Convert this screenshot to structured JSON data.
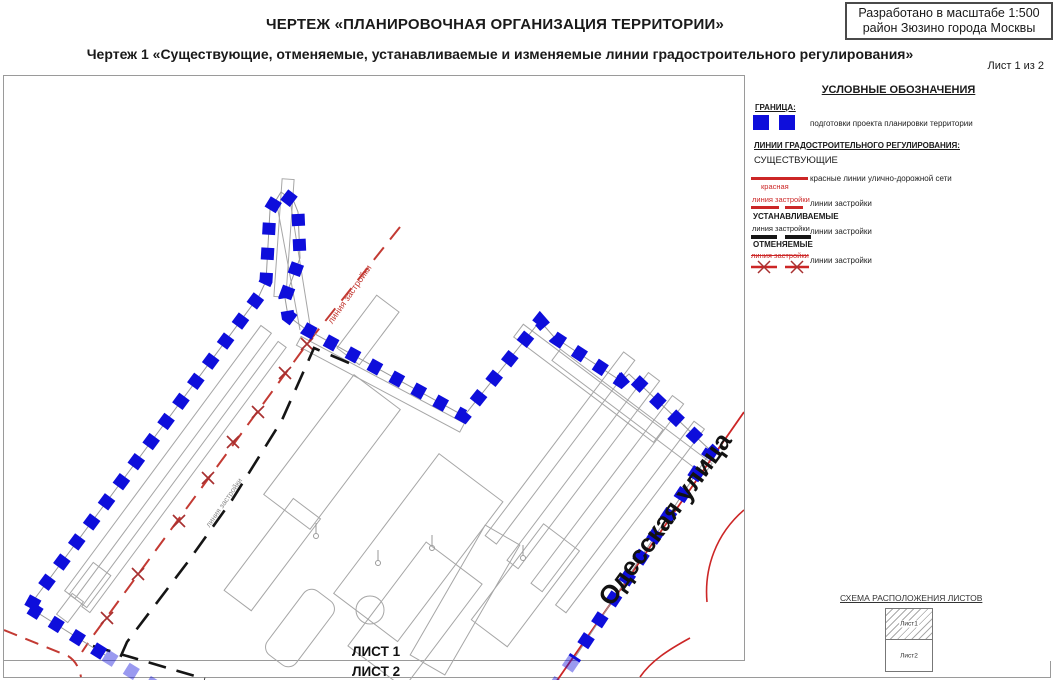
{
  "header": {
    "title": "ЧЕРТЕЖ «ПЛАНИРОВОЧНАЯ ОРГАНИЗАЦИЯ ТЕРРИТОРИИ»",
    "subtitle": "Чертеж 1 «Существующие, отменяемые, устанавливаемые и изменяемые линии градостроительного регулирования»",
    "sheet_indicator": "Лист 1 из 2",
    "scale_box": {
      "line1": "Разработано в масштабе 1:500",
      "line2": "район Зюзино города Москвы"
    }
  },
  "map": {
    "street_label": "Одесская улица",
    "red_building_line_label": "линия застройки",
    "gray_building_line_label": "линия застройки",
    "sheet1_label": "ЛИСТ 1",
    "sheet2_label": "ЛИСТ 2"
  },
  "legend": {
    "title": "УСЛОВНЫЕ ОБОЗНАЧЕНИЯ",
    "boundary_heading": "ГРАНИЦА:",
    "boundary_item": "подготовки проекта планировки территории",
    "reg_lines_heading": "ЛИНИИ ГРАДОСТРОИТЕЛЬНОГО РЕГУЛИРОВАНИЯ:",
    "existing_heading": "СУЩЕСТВУЮЩИЕ",
    "red_lines_item": "красные линии улично-дорожной сети",
    "red_line_caption": "красная",
    "existing_caption": "линия застройки",
    "existing_item": "линии застройки",
    "established_heading": "УСТАНАВЛИВАЕМЫЕ",
    "established_caption": "линия застройки",
    "established_item": "линии застройки",
    "cancelled_heading": "ОТМЕНЯЕМЫЕ",
    "cancelled_caption": "линия застройки",
    "cancelled_item": "линии застройки"
  },
  "sheet_scheme": {
    "title": "СХЕМА РАСПОЛОЖЕНИЯ ЛИСТОВ",
    "sheet1": "Лист1",
    "sheet2": "Лист2"
  },
  "colors": {
    "boundary_blue": "#0e0edb",
    "red_line": "#cc2626",
    "cancel_x_red": "#a83030",
    "established_black": "#151515",
    "building_gray": "#a6a6a6"
  }
}
